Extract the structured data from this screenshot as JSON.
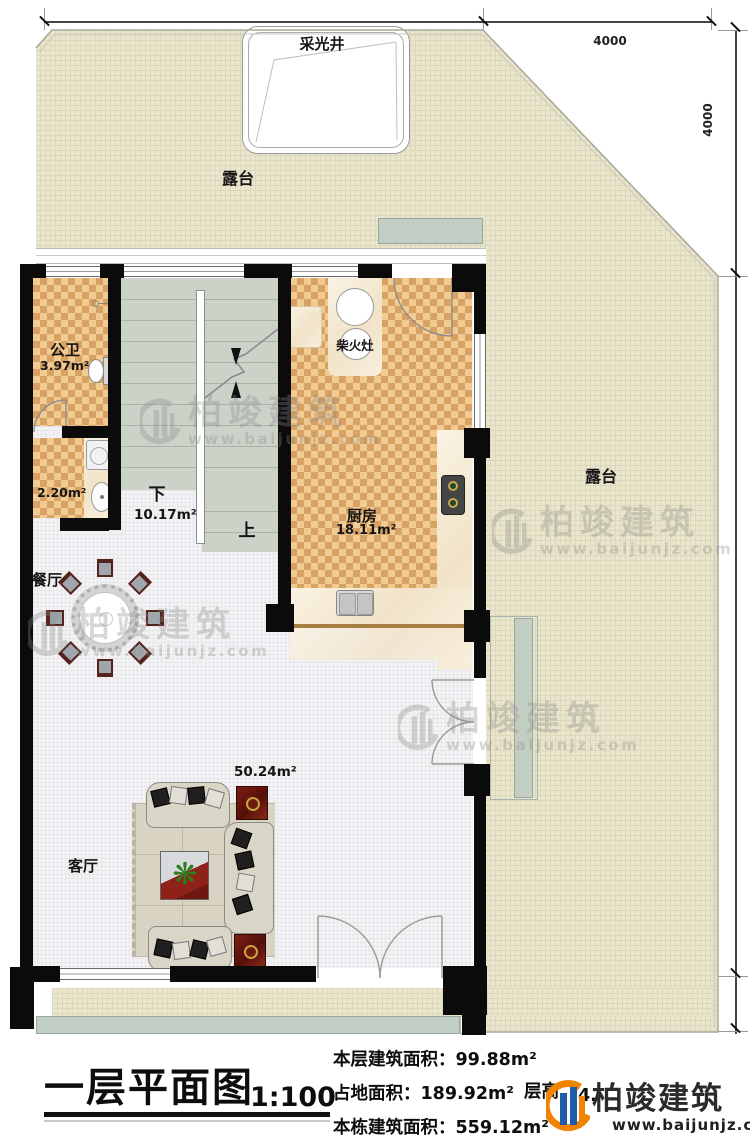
{
  "plan": {
    "title": "一层平面图",
    "scale": "1:100",
    "stats": [
      {
        "label": "本层建筑面积：",
        "value": "99.88m²"
      },
      {
        "label": "占地面积：",
        "value": "189.92m²"
      },
      {
        "label": "本栋建筑面积：",
        "value": "559.12m²"
      }
    ],
    "floor_height_label": "层高",
    "floor_height_value": "4.",
    "brand": {
      "name": "柏竣建筑",
      "url": "www.baijunjz.com"
    },
    "watermark": {
      "name": "柏竣建筑",
      "url": "www.baijunjz.com"
    }
  },
  "dimensions": {
    "top_left": "7600",
    "top_right": "4000",
    "right_upper": "4000",
    "right_middle": "11700",
    "right_lower": "800"
  },
  "rooms": {
    "terrace": "露台",
    "skylight": "采光井",
    "bathroom": {
      "name": "公卫",
      "area": "3.97m²"
    },
    "laundry": {
      "area": "2.20m²"
    },
    "stairs": {
      "down": "下",
      "area": "10.17m²",
      "up": "上"
    },
    "kitchen": {
      "name": "厨房",
      "area": "18.11m²"
    },
    "wood_stove": "柴火灶",
    "dining": {
      "name": "餐厅"
    },
    "living": {
      "name": "客厅",
      "area": "50.24m²"
    }
  }
}
